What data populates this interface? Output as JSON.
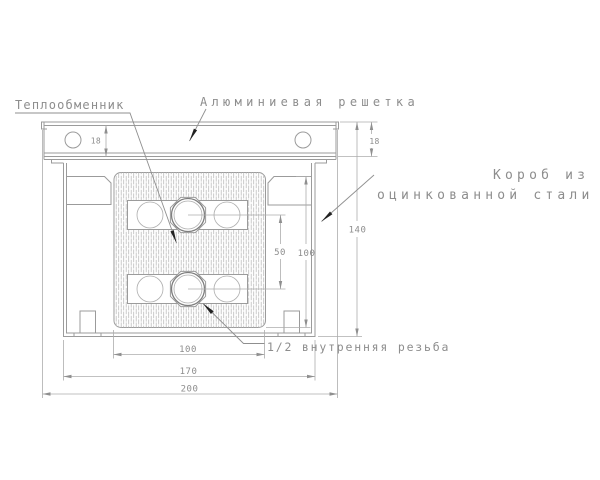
{
  "drawing": {
    "callouts": {
      "heat_exchanger": "Теплообменник",
      "aluminum_grille": "Алюминиевая решетка",
      "steel_box_line1": "Короб из",
      "steel_box_line2": "оцинкованной стали",
      "thread": "1/2 внутренняя резьба"
    },
    "dimensions": {
      "grille_height_left": "18",
      "grille_height_right": "18",
      "box_height": "140",
      "tube_spacing": "50",
      "core_height": "100",
      "core_width": "100",
      "box_width": "170",
      "overall_width": "200"
    },
    "colors": {
      "background": "#ffffff",
      "line": "#9b9b9b",
      "dark_line": "#7e7e7e",
      "hatch": "#bcbcbc",
      "text": "#8d8d8d",
      "leader_arrow": "#222222"
    }
  }
}
